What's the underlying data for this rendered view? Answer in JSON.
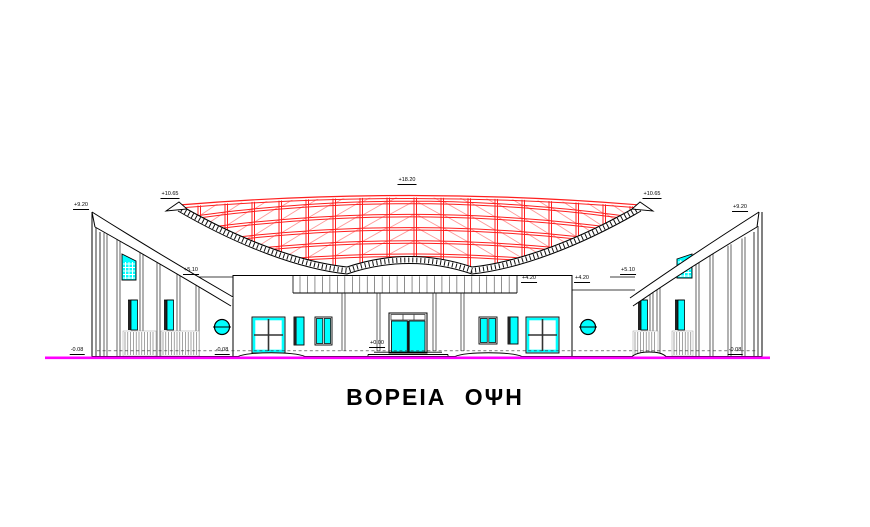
{
  "drawing_title": "ΒΟΡΕΙΑ ΟΨΗ",
  "colors": {
    "outline": "#000000",
    "truss_red": "#ff1f1f",
    "truss_red_light": "#ff9a9a",
    "glazing_cyan": "#00ffff",
    "ground_magenta": "#ff00ff",
    "paper_white": "#ffffff"
  },
  "elevation_markers": [
    {
      "label": "+9.20",
      "x": 81,
      "y": 203
    },
    {
      "label": "+10.65",
      "x": 170,
      "y": 192
    },
    {
      "label": "+18.20",
      "x": 407,
      "y": 178
    },
    {
      "label": "+10.65",
      "x": 652,
      "y": 192
    },
    {
      "label": "+9.20",
      "x": 740,
      "y": 205
    },
    {
      "label": "+5.10",
      "x": 191,
      "y": 268
    },
    {
      "label": "+5.10",
      "x": 628,
      "y": 268
    },
    {
      "label": "+4.20",
      "x": 529,
      "y": 276
    },
    {
      "label": "+4.20",
      "x": 582,
      "y": 276
    },
    {
      "label": "+0.00",
      "x": 377,
      "y": 341
    },
    {
      "label": "-0.08",
      "x": 77,
      "y": 348
    },
    {
      "label": "-0.08",
      "x": 222,
      "y": 348
    },
    {
      "label": "-0.08",
      "x": 735,
      "y": 348
    }
  ]
}
